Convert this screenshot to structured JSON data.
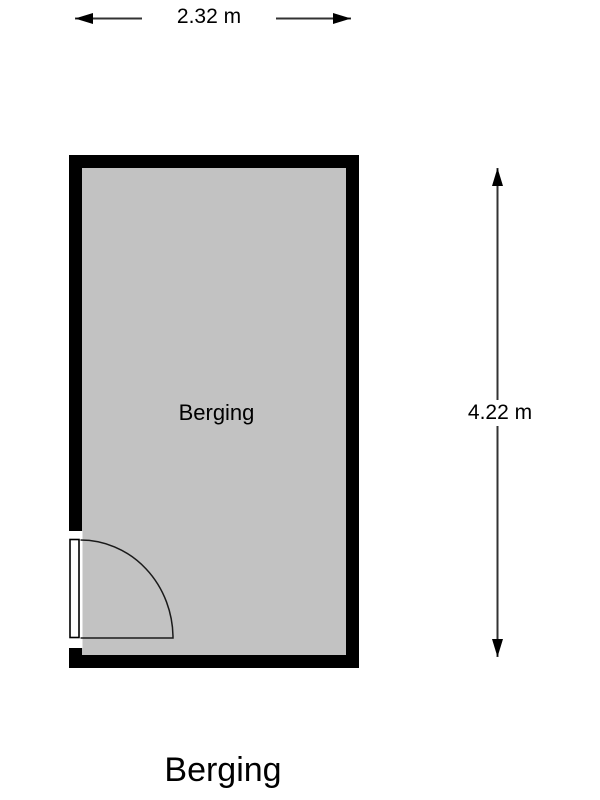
{
  "floorplan": {
    "title": "Berging",
    "room": {
      "label": "Berging",
      "wall_color": "#000000",
      "floor_color": "#c2c2c2"
    },
    "door": {
      "symbol": "single-swing-door",
      "position": "bottom-left-wall"
    },
    "dimensions": {
      "width": {
        "label": "2.32 m",
        "value_m": 2.32,
        "orientation": "horizontal"
      },
      "height": {
        "label": "4.22 m",
        "value_m": 4.22,
        "orientation": "vertical"
      }
    },
    "background_color": "#ffffff"
  }
}
